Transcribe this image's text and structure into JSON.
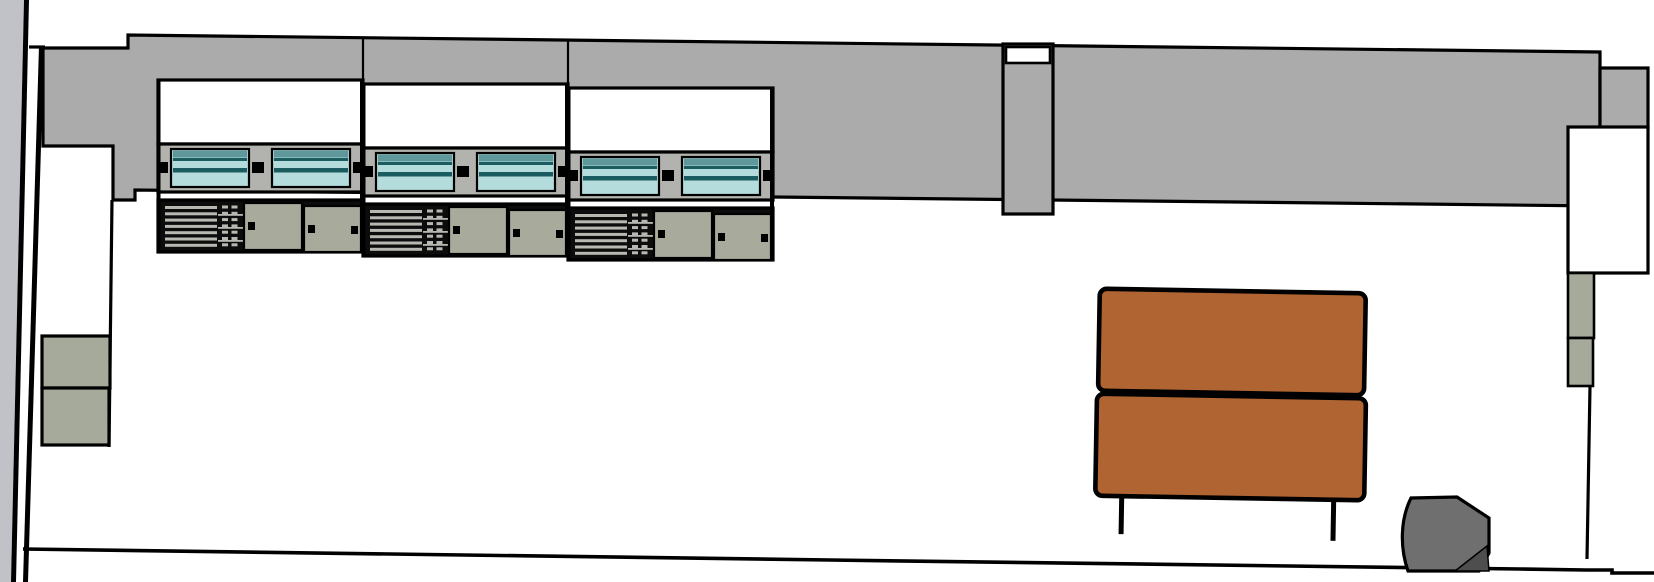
{
  "scene": {
    "canvas": {
      "width": 1654,
      "height": 582,
      "background": "#ffffff"
    },
    "colors": {
      "outline": "#000000",
      "side_wall": "#c0c2c8",
      "wall_band": "#ababab",
      "column": "#ababab",
      "panel_white": "#ffffff",
      "frame_gray": "#b2b3ae",
      "glass_light": "#b4dcdc",
      "glass_mid": "#5f989b",
      "glass_dark": "#1b5c60",
      "cabinet_black": "#0c0c0c",
      "slat_gray": "#b7b8b1",
      "door_sage": "#a8ab9c",
      "box_sage": "#a6aa9b",
      "sofa_orange": "#b06431",
      "ottoman_gray": "#6f6f6f",
      "ottoman_shadow": "#4e4e4e"
    },
    "workstations": {
      "unit_count": 3,
      "unit_width": 205,
      "unit_height": 172,
      "units": [
        {
          "transform": "translate(158,80)"
        },
        {
          "transform": "translate(363,84)"
        },
        {
          "transform": "translate(568,88)"
        }
      ],
      "glass_windows_per_unit": 2,
      "sliding_doors_per_unit": 2
    },
    "sofa": {
      "transform": "rotate(1 1230 395)",
      "cushions": 2,
      "legs": 2
    },
    "pilasters": {
      "left_boxes": 2,
      "right_boxes": 2
    }
  }
}
